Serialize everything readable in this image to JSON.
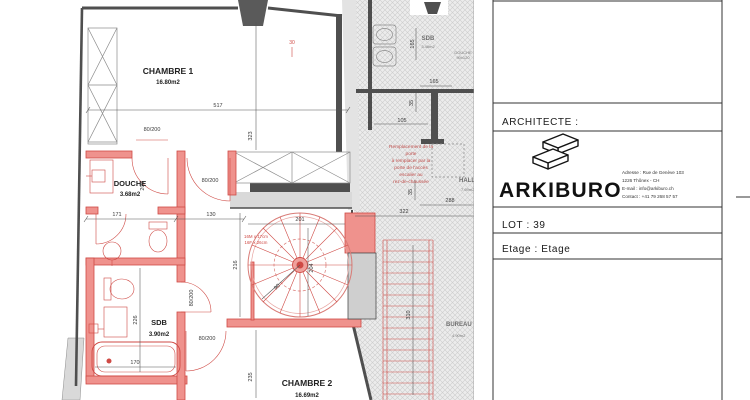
{
  "plan": {
    "rooms": {
      "chambre1": {
        "name": "CHAMBRE 1",
        "area": "16.80m2"
      },
      "chambre2": {
        "name": "CHAMBRE 2",
        "area": "16.69m2"
      },
      "douche": {
        "name": "DOUCHE",
        "area": "3.68m2"
      },
      "sdb": {
        "name": "SDB",
        "area": "3.90m2"
      },
      "sdb_haut": {
        "name": "SDB",
        "area": "3.46m2"
      },
      "hall": {
        "name": "HALL",
        "area": "7.69m2"
      },
      "bureau": {
        "name": "BUREAU",
        "area": "4.90m2"
      }
    },
    "door_label": "80/200",
    "dims": {
      "d517": "517",
      "d323": "323",
      "d171": "171",
      "d130": "130",
      "d200": "200",
      "d226": "226",
      "d170": "170",
      "d235": "235",
      "d201": "201",
      "d216": "216",
      "d90": "90",
      "d204": "204",
      "d165": "165",
      "d35": "35",
      "d105": "105",
      "d288": "288",
      "d322": "322",
      "d310": "310",
      "d30": "30"
    },
    "notes": {
      "spiral": [
        "16M x 17cm",
        "16F x 26cm"
      ],
      "shower_top": [
        "DOUCHE",
        "90x120"
      ],
      "replacement": [
        "Remplacement de la",
        "porte",
        "à remplacer par la",
        "porte de l'accès",
        "escalier au",
        "rez-de-chaussée"
      ]
    }
  },
  "title_block": {
    "architect_label": "ARCHITECTE :",
    "brand": "ARKIBURO",
    "address_lines": [
      "Adresse : Rue de Genève 103",
      "1226 Thônex - CH",
      "E-mail : info@arkiburo.ch",
      "Contact : +41 79 268 57 57"
    ],
    "lot_label": "LOT : 39",
    "etage_label": "Etage : Etage"
  },
  "colors": {
    "new_wall_fill": "#ef928d",
    "new_wall_line": "#cf4a45",
    "existing_wall": "#4f4f4f",
    "hatch_bg": "#ececec",
    "dim_text": "#3a3a3a"
  }
}
